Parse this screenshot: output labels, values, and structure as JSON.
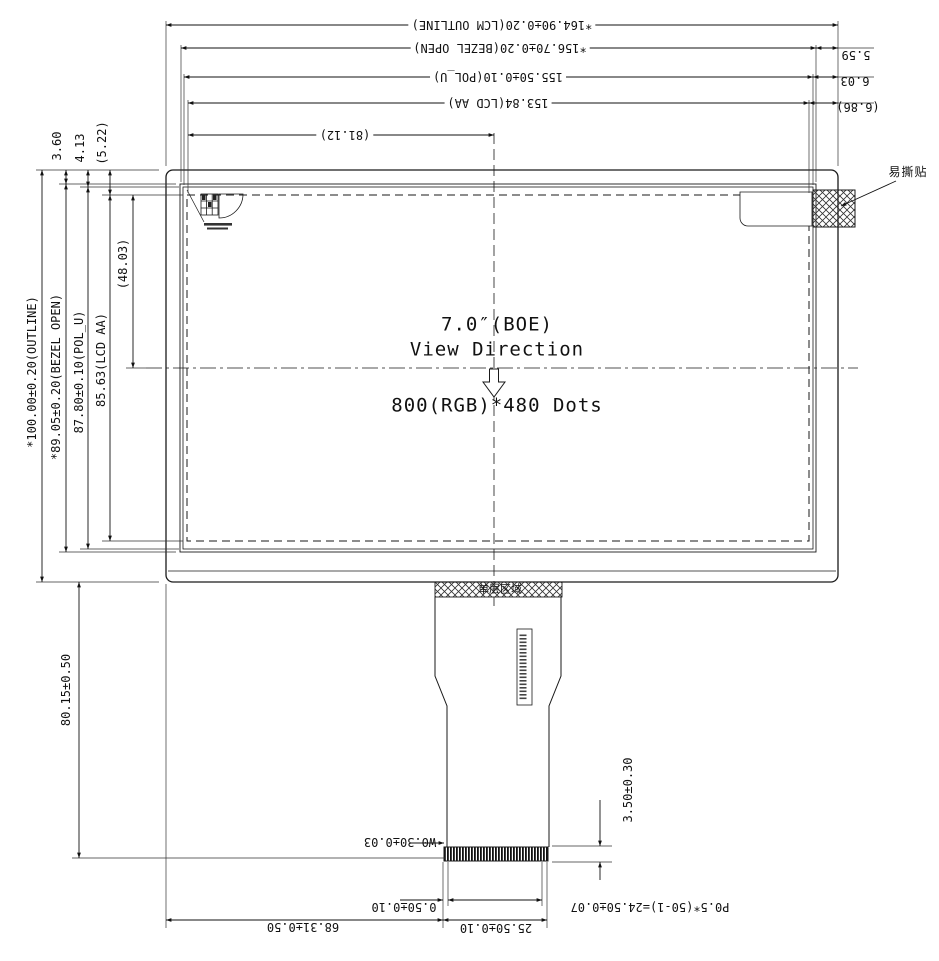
{
  "drawing": {
    "display": {
      "size_label": "7.0″(BOE)",
      "view_direction_label": "View Direction",
      "resolution_label": "800(RGB)*480 Dots"
    },
    "dims": {
      "top": {
        "lcm_outline": "*164.90±0.20(LCM OUTLINE)",
        "bezel_open": "*156.70±0.20(BEZEL OPEN)",
        "pol_u": "155.50±0.10(POL_U)",
        "lcd_aa": "153.84(LCD AA)",
        "aa_center_width": "(81.12)"
      },
      "top_right": {
        "bezel_margin": "5.59",
        "pol_margin": "6.03",
        "aa_margin": "(6.86)"
      },
      "top_left": {
        "bezel_margin": "3.60",
        "pol_margin": "4.13",
        "aa_margin": "(5.22)"
      },
      "left": {
        "outline": "*100.00±0.20(OUTLINE)",
        "bezel_open": "*89.05±0.20(BEZEL OPEN)",
        "pol_u": "87.80±0.10(POL_U)",
        "lcd_aa": "85.63(LCD AA)",
        "aa_center_height": "(48.03)"
      },
      "bottom": {
        "fpc_length": "80.15±0.50",
        "fpc_offset": "68.31±0.50",
        "connector_width": "25.50±0.10",
        "edge_margin": "0.50±0.10",
        "pin_pitch": "P0.5*(50-1)=24.50±0.07",
        "pin_width": "W0.30±0.03",
        "connector_height": "3.50±0.30"
      }
    },
    "annotations": {
      "tear_sticker": "易撕贴",
      "single_layer_area": "单层区域"
    }
  }
}
